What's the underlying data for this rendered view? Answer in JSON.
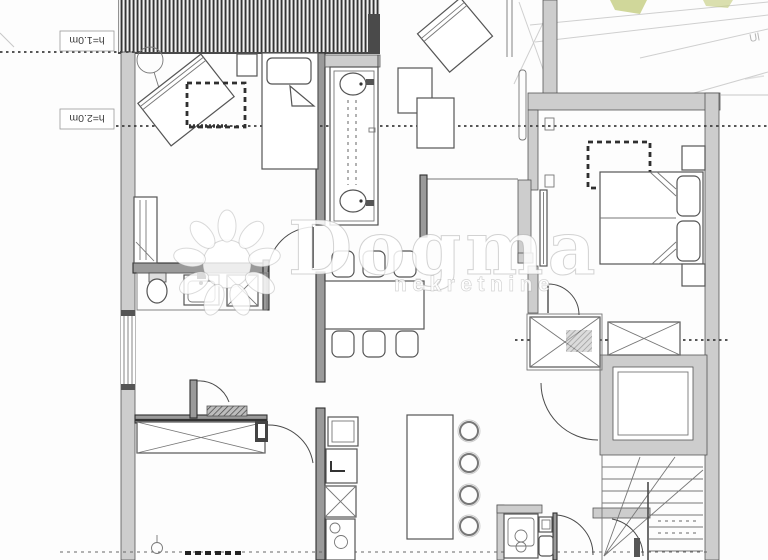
{
  "canvas": {
    "width": 768,
    "height": 560,
    "background": "#fdfdfd"
  },
  "annotations": {
    "attic_low": "h=1.0m",
    "attic_high": "h=2.0m"
  },
  "watermark": {
    "brand": "Dogma",
    "tagline": "nekretnine",
    "logo": "sun-rays-icon"
  },
  "site_plan": {
    "street_label": "Ul",
    "green_color": "#b7c262"
  },
  "palette": {
    "line_dark": "#3c3c3c",
    "line_mid": "#777777",
    "wall_fill": "#cdcdcd",
    "wall_dark": "#9a9a9a",
    "roof_stripe": "#333333",
    "map_line": "#b6b6b6",
    "dash_line": "#3f3f3f",
    "watermark_fill": "rgba(255,255,255,0.85)",
    "watermark_edge": "rgba(150,150,150,0.42)"
  },
  "plan_features": [
    "pitched-roof-hatch",
    "attic-height-limit-lines",
    "bedroom-with-roof-window",
    "angled-single-bed",
    "single-bed",
    "double-bed-two-pillows",
    "bathroom-double-vanity",
    "toilet",
    "kitchenette-sink-stove",
    "dining-table-six-chairs",
    "kitchen-island-four-stools",
    "x-wardrobes",
    "entry-doormat",
    "pocket-door",
    "winder-staircase",
    "washing-machine",
    "utility-bathroom",
    "site-map-corner"
  ]
}
